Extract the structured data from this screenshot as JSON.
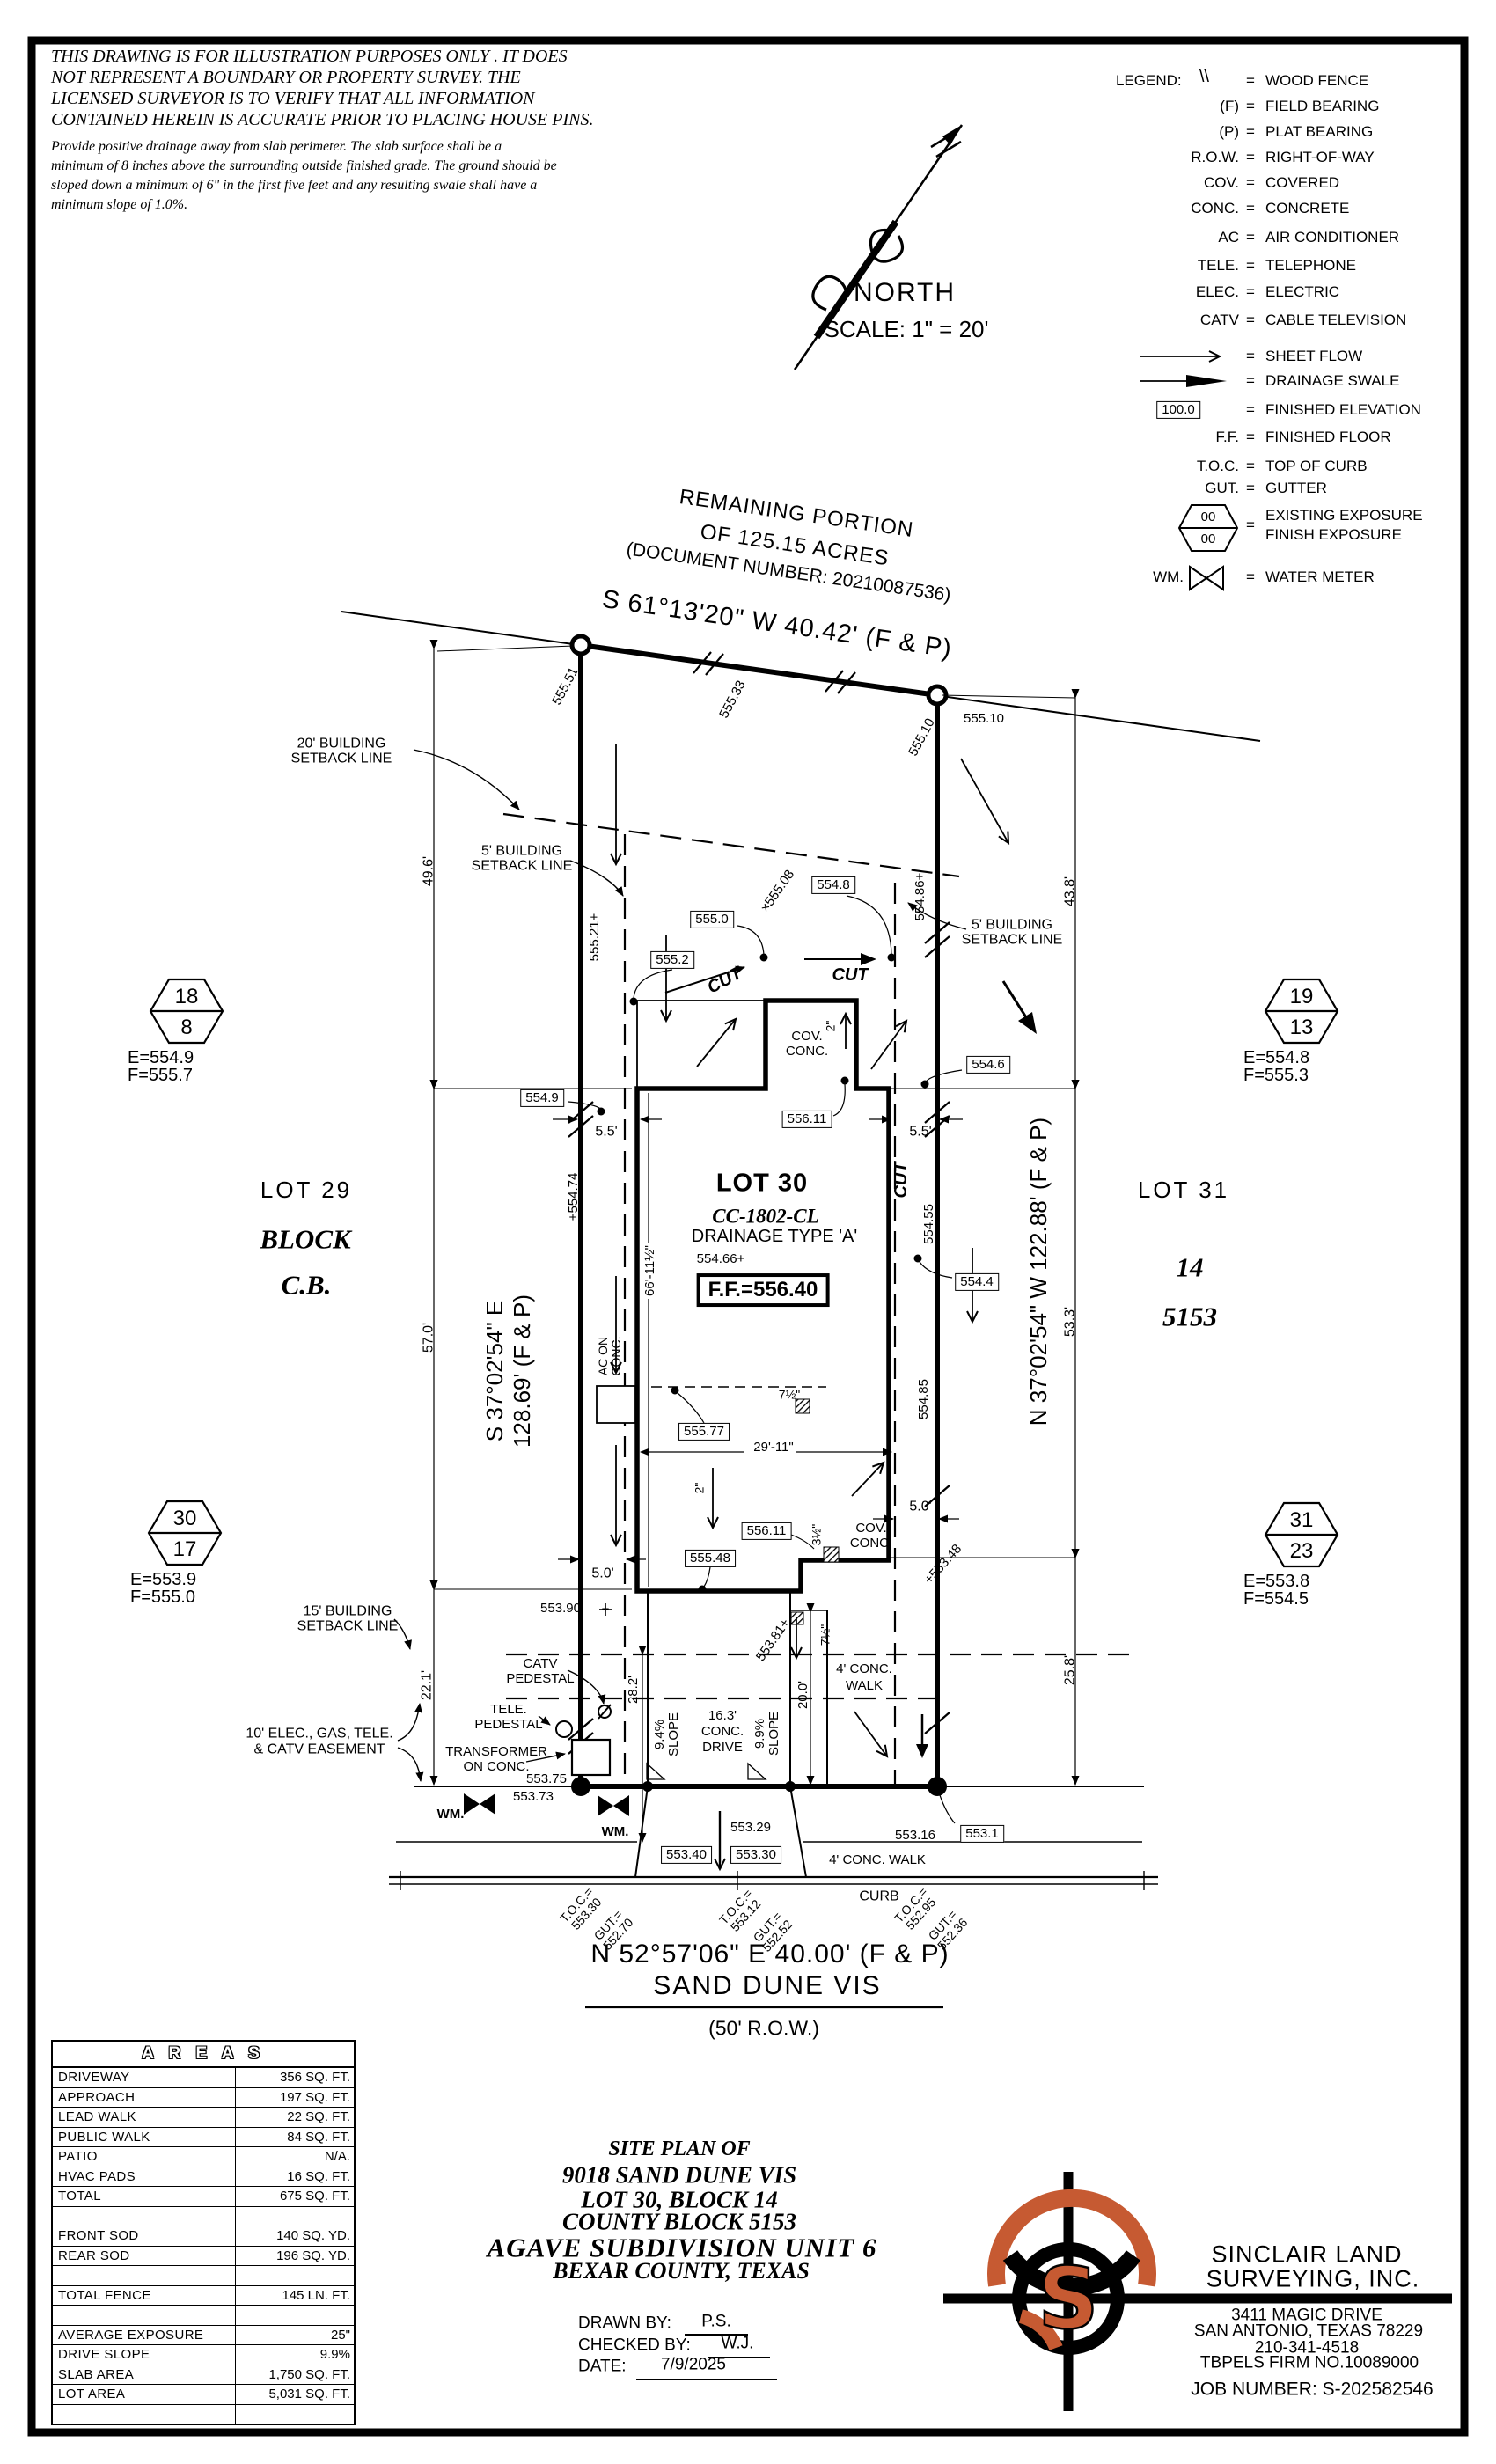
{
  "disclaimer": {
    "l1": "THIS DRAWING IS FOR ILLUSTRATION PURPOSES ONLY . IT DOES",
    "l2": "NOT REPRESENT A BOUNDARY OR PROPERTY SURVEY. THE",
    "l3": "LICENSED SURVEYOR IS TO VERIFY THAT ALL INFORMATION",
    "l4": "CONTAINED HEREIN IS ACCURATE PRIOR TO PLACING HOUSE PINS.",
    "n1": "Provide positive drainage away from slab perimeter. The slab surface shall be a",
    "n2": "minimum of 8 inches above the surrounding outside finished grade. The ground should be",
    "n3": "sloped down a minimum of 6\" in the first five feet and any resulting swale shall have a",
    "n4": "minimum slope of 1.0%."
  },
  "north": {
    "label": "NORTH",
    "scale": "SCALE:  1\" =  20'"
  },
  "legend": {
    "title": "LEGEND:",
    "rows": [
      {
        "sym": "\\\\",
        "def": "WOOD FENCE"
      },
      {
        "sym": "(F)",
        "def": "FIELD BEARING"
      },
      {
        "sym": "(P)",
        "def": "PLAT BEARING"
      },
      {
        "sym": "R.O.W.",
        "def": "RIGHT-OF-WAY"
      },
      {
        "sym": "COV.",
        "def": "COVERED"
      },
      {
        "sym": "CONC.",
        "def": "CONCRETE"
      },
      {
        "sym": "AC",
        "def": "AIR CONDITIONER"
      },
      {
        "sym": "TELE.",
        "def": "TELEPHONE"
      },
      {
        "sym": "ELEC.",
        "def": "ELECTRIC"
      },
      {
        "sym": "CATV",
        "def": "CABLE TELEVISION"
      },
      {
        "sym": "",
        "def": "SHEET FLOW"
      },
      {
        "sym": "",
        "def": "DRAINAGE SWALE"
      },
      {
        "sym": "100.0",
        "def": "FINISHED ELEVATION"
      },
      {
        "sym": "F.F.",
        "def": "FINISHED FLOOR"
      },
      {
        "sym": "T.O.C.",
        "def": "TOP OF CURB"
      },
      {
        "sym": "GUT.",
        "def": "GUTTER"
      },
      {
        "sym": "00 / 00",
        "top": "00",
        "bot": "00",
        "def": "EXISTING EXPOSURE",
        "def2": "FINISH EXPOSURE"
      },
      {
        "sym": "WM.",
        "def": "WATER METER"
      }
    ]
  },
  "plat": {
    "remaining1": "REMAINING PORTION",
    "remaining2": "OF 125.15 ACRES",
    "remaining3": "(DOCUMENT NUMBER: 20210087536)",
    "bearing_top": "S 61°13'20\" W 40.42' (F & P)",
    "bearing_left1": "S 37°02'54\" E",
    "bearing_left2": "128.69' (F & P)",
    "bearing_right": "N 37°02'54\" W 122.88' (F & P)",
    "lot29": "LOT 29",
    "block29_1": "BLOCK",
    "block29_2": "C.B.",
    "lot31": "LOT 31",
    "block31_1": "14",
    "block31_2": "5153",
    "lot30": "LOT 30",
    "plan": "CC-1802-CL",
    "drainage": "DRAINAGE TYPE 'A'",
    "pad_elev": "554.66+",
    "ff": "F.F.=556.40",
    "setback20_1": "20' BUILDING",
    "setback_line": "SETBACK LINE",
    "setback5_1": "5' BUILDING",
    "setback15_1": "15' BUILDING",
    "easement1": "10' ELEC., GAS, TELE.",
    "easement2": "& CATV EASEMENT",
    "catv1": "CATV",
    "catv2": "PEDESTAL",
    "tele1": "TELE.",
    "tele2": "PEDESTAL",
    "xfmr1": "TRANSFORMER",
    "xfmr2": "ON CONC.",
    "ac1": "AC ON",
    "ac2": "CONC.",
    "cov1": "COV.",
    "cov2": "CONC.",
    "cut": "CUT",
    "wm": "WM.",
    "walk1": "4' CONC.",
    "walk2": "WALK",
    "dims": {
      "d496": "49.6'",
      "d570": "57.0'",
      "d221": "22.1'",
      "d438": "43.8'",
      "d533": "53.3'",
      "d258": "25.8'",
      "d55": "5.5'",
      "d50": "5.0'",
      "d2911": "29'-11\"",
      "d6611": "66'-11½\"",
      "d282": "28.2'",
      "d200": "20.0'",
      "d163": "16.3'",
      "conc": "CONC.",
      "drive": "DRIVE",
      "s94": "9.4%",
      "s99": "9.9%",
      "slope": "SLOPE",
      "d2": "2\"",
      "d35": "3½\"",
      "d75": "7½\""
    },
    "elev": {
      "e55551": "555.51",
      "e55533": "555.33",
      "e55510": "555.10",
      "e55521": "555.21+",
      "e55474": "+554.74",
      "e55508": "×555.08",
      "e55486": "554.86+",
      "e55455": "554.55",
      "e55485": "554.85",
      "e55348": "+553.48",
      "e55381": "553.81+",
      "e55390": "553.90",
      "plus": "+",
      "e55375": "553.75",
      "e55373": "553.73",
      "e55329": "553.29",
      "e55316": "553.16"
    },
    "box": {
      "b5550": "555.0",
      "b5552": "555.2",
      "b5548": "554.8",
      "b5549": "554.9",
      "b5546": "554.6",
      "b5544": "554.4",
      "b55611": "556.11",
      "b55577": "555.77",
      "b55548": "555.48",
      "b55340": "553.40",
      "b55330": "553.30",
      "b5531": "553.1"
    },
    "hex": {
      "h18t": "18",
      "h18b": "8",
      "h18e": "E=554.9",
      "h18f": "F=555.7",
      "h19t": "19",
      "h19b": "13",
      "h19e": "E=554.8",
      "h19f": "F=555.3",
      "h30t": "30",
      "h30b": "17",
      "h30e": "E=553.9",
      "h30f": "F=555.0",
      "h31t": "31",
      "h31b": "23",
      "h31e": "E=553.8",
      "h31f": "F=554.5"
    }
  },
  "street": {
    "bearing": "N 52°57'06\" E 40.00' (F & P)",
    "name": "SAND DUNE VIS",
    "row": "(50' R.O.W.)",
    "curb": "CURB",
    "walk": "4' CONC. WALK",
    "toc_label": "T.O.C.=",
    "gut_label": "GUT.=",
    "toc1": "553.30",
    "gut1": "552.70",
    "toc2": "553.12",
    "gut2": "552.52",
    "toc3": "552.95",
    "gut3": "552.36"
  },
  "areas": {
    "title": "A R E A S",
    "rows": [
      {
        "label": "DRIVEWAY",
        "value": "356 SQ. FT."
      },
      {
        "label": "APPROACH",
        "value": "197 SQ. FT."
      },
      {
        "label": "LEAD WALK",
        "value": "22 SQ. FT."
      },
      {
        "label": "PUBLIC WALK",
        "value": "84 SQ. FT."
      },
      {
        "label": "PATIO",
        "value": "N/A."
      },
      {
        "label": "HVAC PADS",
        "value": "16 SQ. FT."
      },
      {
        "label": "TOTAL",
        "value": "675 SQ. FT."
      },
      {
        "label": "",
        "value": ""
      },
      {
        "label": "FRONT SOD",
        "value": "140 SQ. YD."
      },
      {
        "label": "REAR SOD",
        "value": "196 SQ. YD."
      },
      {
        "label": "",
        "value": ""
      },
      {
        "label": "TOTAL FENCE",
        "value": "145 LN. FT."
      },
      {
        "label": "",
        "value": ""
      },
      {
        "label": "AVERAGE EXPOSURE",
        "value": "25\""
      },
      {
        "label": "DRIVE SLOPE",
        "value": "9.9%"
      },
      {
        "label": "SLAB AREA",
        "value": "1,750 SQ. FT."
      },
      {
        "label": "LOT AREA",
        "value": "5,031 SQ. FT."
      },
      {
        "label": "",
        "value": ""
      }
    ]
  },
  "title_block": {
    "l1": "SITE PLAN OF",
    "l2": "9018 SAND DUNE VIS",
    "l3": "LOT 30, BLOCK 14",
    "l4": "COUNTY BLOCK 5153",
    "l5": "AGAVE SUBDIVISION UNIT 6",
    "l6": "BEXAR COUNTY, TEXAS",
    "drawn": "DRAWN BY:",
    "drawn_v": "P.S.",
    "checked": "CHECKED BY:",
    "checked_v": "W.J.",
    "date": "DATE:",
    "date_v": "7/9/2025"
  },
  "firm": {
    "logo_s": "S",
    "name1": "SINCLAIR LAND",
    "name2": "SURVEYING, INC.",
    "addr1": "3411 MAGIC DRIVE",
    "addr2": "SAN ANTONIO, TEXAS 78229",
    "addr3": "210-341-4518",
    "addr4": "TBPELS FIRM NO.10089000",
    "job": "JOB NUMBER:  S-202582546"
  },
  "colors": {
    "accent": "#C65A32",
    "ink": "#000000"
  }
}
